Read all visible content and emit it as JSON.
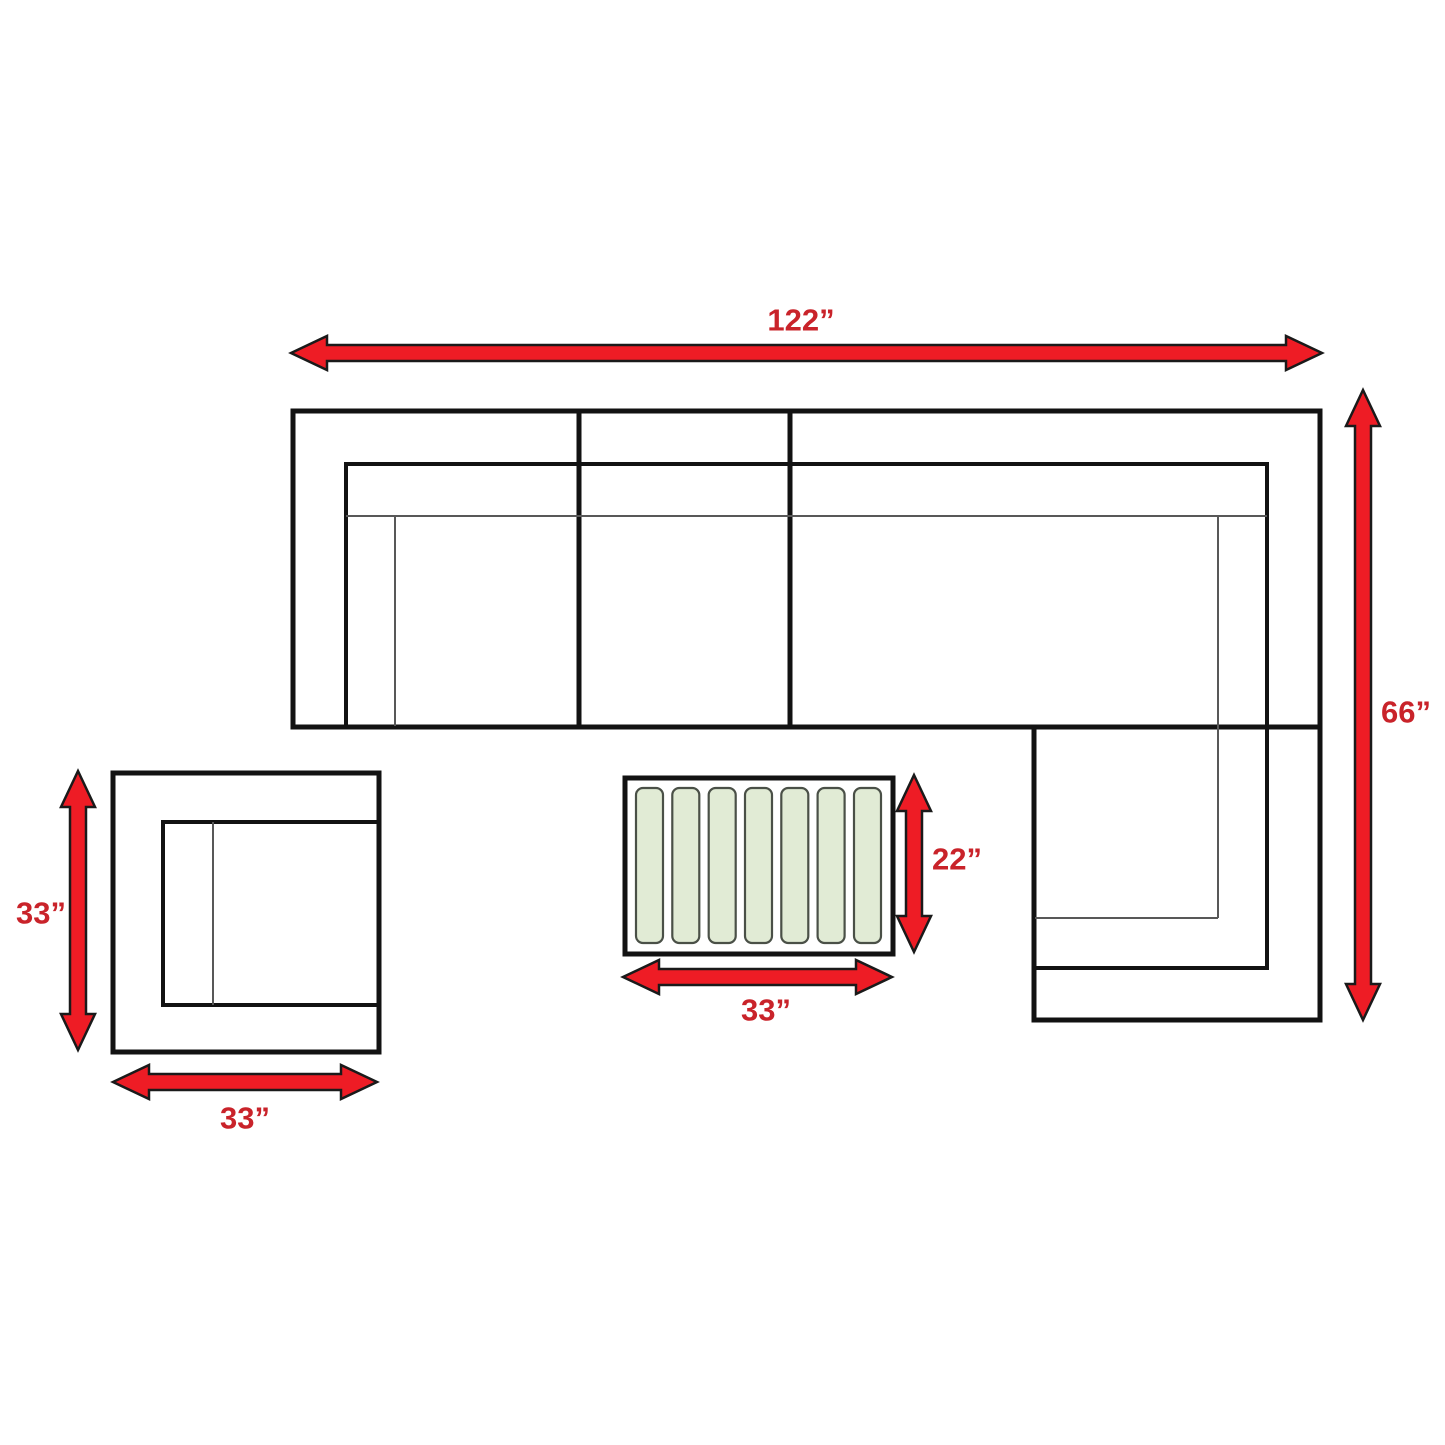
{
  "diagram": {
    "kind": "furniture dimension diagram",
    "pieces": [
      {
        "id": "sectional-sofa",
        "width_label": "122”",
        "depth_label": "66”",
        "seat_sections": 4
      },
      {
        "id": "corner-unit",
        "side_label": "33”",
        "width_label": "33”"
      },
      {
        "id": "coffee-table",
        "depth_label": "22”",
        "width_label": "33”",
        "slat_count": 7
      }
    ]
  },
  "colors": {
    "background": "#ffffff",
    "arrow_fill": "#ee1c25",
    "arrow_outline": "#1a1a1a",
    "dimension_text": "#c9232a",
    "outline_thick": "#121212",
    "outline_thin": "#585858",
    "slat_fill": "#e1ebd5",
    "slat_border": "#4a5047"
  }
}
